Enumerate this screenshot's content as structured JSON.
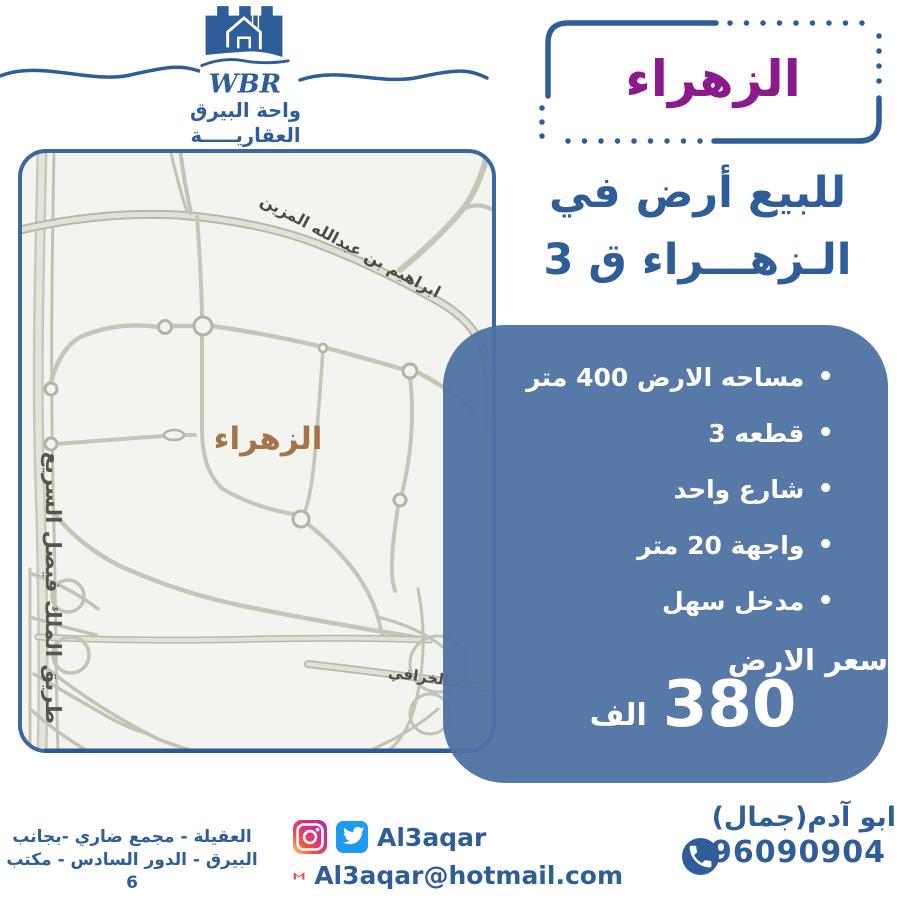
{
  "brand": {
    "wbr": "WBR",
    "name_line1": "واحة البيرق",
    "name_line2": "العقاريـــــة"
  },
  "title_box": {
    "label": "الزهراء"
  },
  "headline": {
    "line1": "للبيع أرض في",
    "line2": "الـزهـــراء ق 3"
  },
  "map": {
    "area_label": "الزهراء",
    "road_left": "طريق الملك فيصل السريع",
    "road_diagonal": "ابراهيم بن عبدالله المزين",
    "road_bottom": "الخرافي"
  },
  "details": {
    "bullets": [
      "مساحه الارض 400 متر",
      "قطعه 3",
      "شارع واحد",
      "واجهة 20 متر",
      "مدخل سهل"
    ],
    "price_label": "سعر الارض",
    "price_value": "380",
    "price_unit": "الف"
  },
  "contact": {
    "address_line1": "العقيلة - مجمع ضاري -بجانب",
    "address_line2": "البيرق - الدور السادس - مكتب 6",
    "social_handle": "Al3aqar",
    "email": "Al3aqar@hotmail.com",
    "agent_name": "ابو آدم(جمال)",
    "phone": "96090904"
  },
  "colors": {
    "primary_blue": "#2e5d99",
    "panel_blue": "#4d72a2",
    "accent_purple": "#8b1b8b",
    "map_label_brown": "#a5734a"
  }
}
